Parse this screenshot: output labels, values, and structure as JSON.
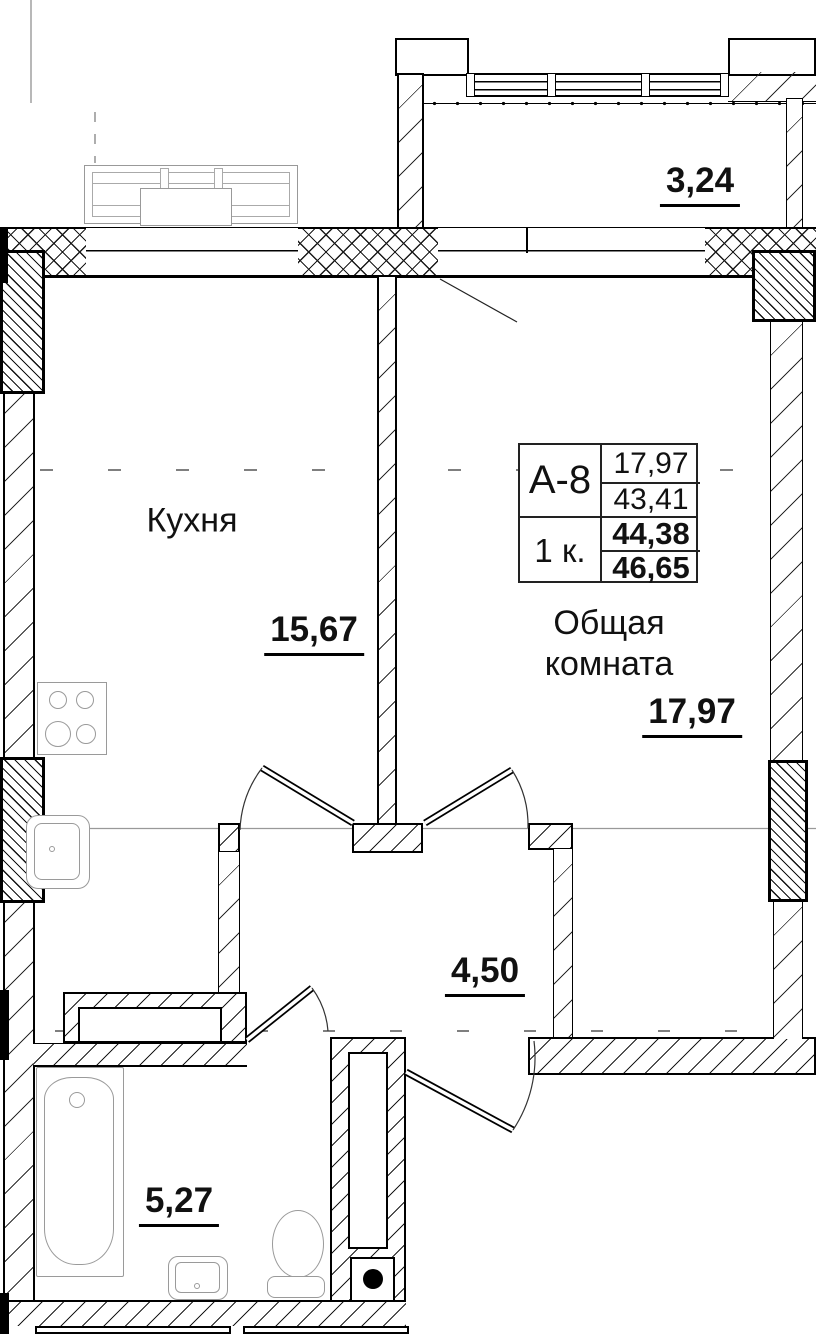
{
  "info_table": {
    "unit": "А-8",
    "unit_type": "1 к.",
    "values": [
      "17,97",
      "43,41",
      "44,38",
      "46,65"
    ]
  },
  "rooms": {
    "kitchen": {
      "label": "Кухня",
      "area": "15,67"
    },
    "living": {
      "label_line1": "Общая",
      "label_line2": "комната",
      "area": "17,97"
    },
    "hallway": {
      "area": "4,50"
    },
    "bathroom": {
      "area": "5,27"
    },
    "balcony": {
      "area": "3,24"
    }
  },
  "colors": {
    "line": "#000000",
    "axis": "#999999",
    "fixture": "#9a9a9a"
  }
}
